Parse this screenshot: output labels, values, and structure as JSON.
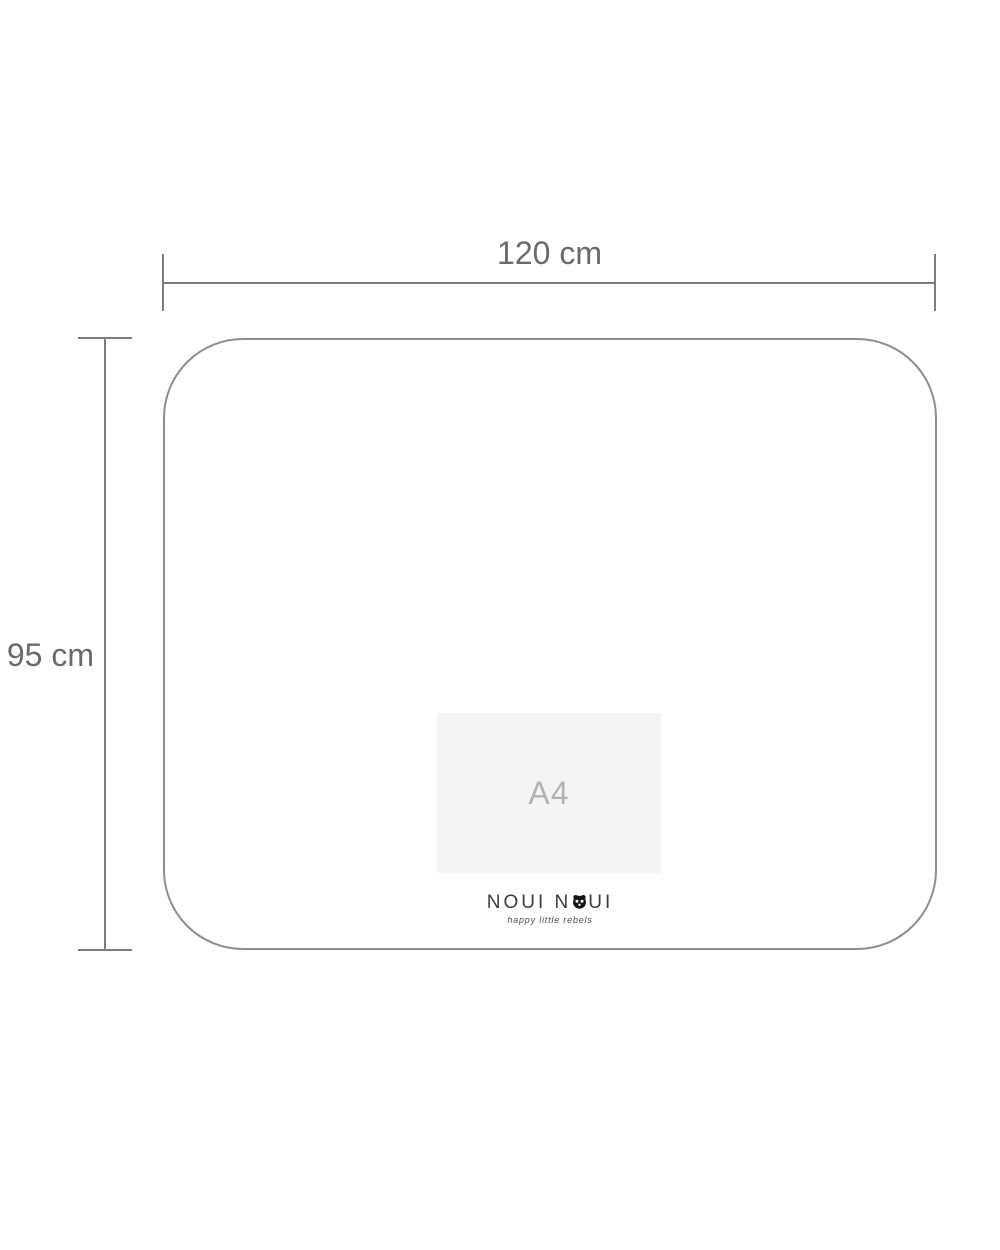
{
  "page": {
    "background": "#ffffff"
  },
  "dimensions": {
    "width": {
      "label": "120 cm"
    },
    "height": {
      "label": "95 cm"
    }
  },
  "mat": {
    "a4_reference_label": "A4"
  },
  "brand": {
    "name_left": "NOUI N",
    "name_right": "UI",
    "panda_icon": "panda-face-icon",
    "tagline": "happy little rebels"
  },
  "colors": {
    "dimension_line": "#7d7d7d",
    "dimension_text": "#6a6a6a",
    "mat_outline": "#8d8d8d",
    "a4_fill": "#f4f4f5",
    "a4_text": "#b2b2b5",
    "brand_text": "#3d3d3d"
  }
}
